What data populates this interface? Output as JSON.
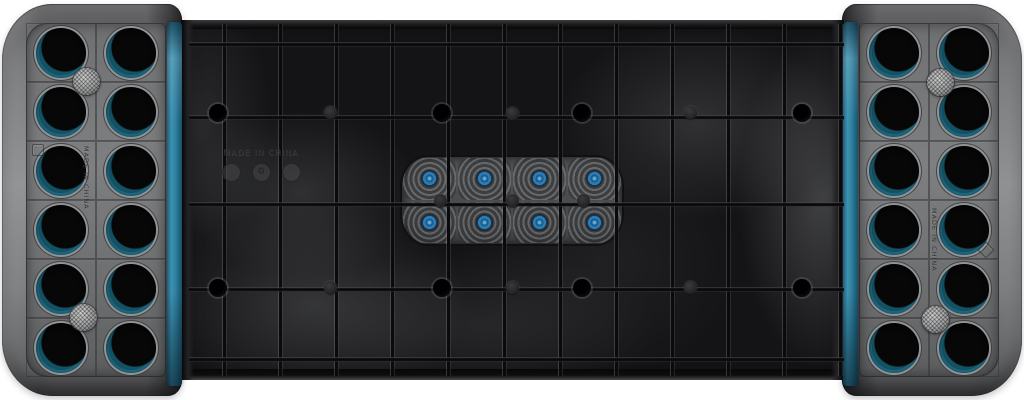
{
  "photo": {
    "subject": "Underside of an aerobic step exercise platform",
    "background_color": "#ffffff"
  },
  "embossing": {
    "origin_text": "MADE IN CHINA",
    "recycle_icon": "♻"
  },
  "materials": {
    "body_plastic_color": "#1a1a1c",
    "end_cap_color": "#77787a",
    "accent_teal": "#2f7f9e",
    "socket_teal": "#1f6c84",
    "grip_target_blue": "#2e7cb4"
  },
  "structure": {
    "end_caps": 2,
    "riser_socket_rows_per_cap": 6,
    "riser_socket_columns_per_cap": 2,
    "grip_pad_targets": 8,
    "knurled_plugs": 4,
    "certification_stamps": 3
  }
}
